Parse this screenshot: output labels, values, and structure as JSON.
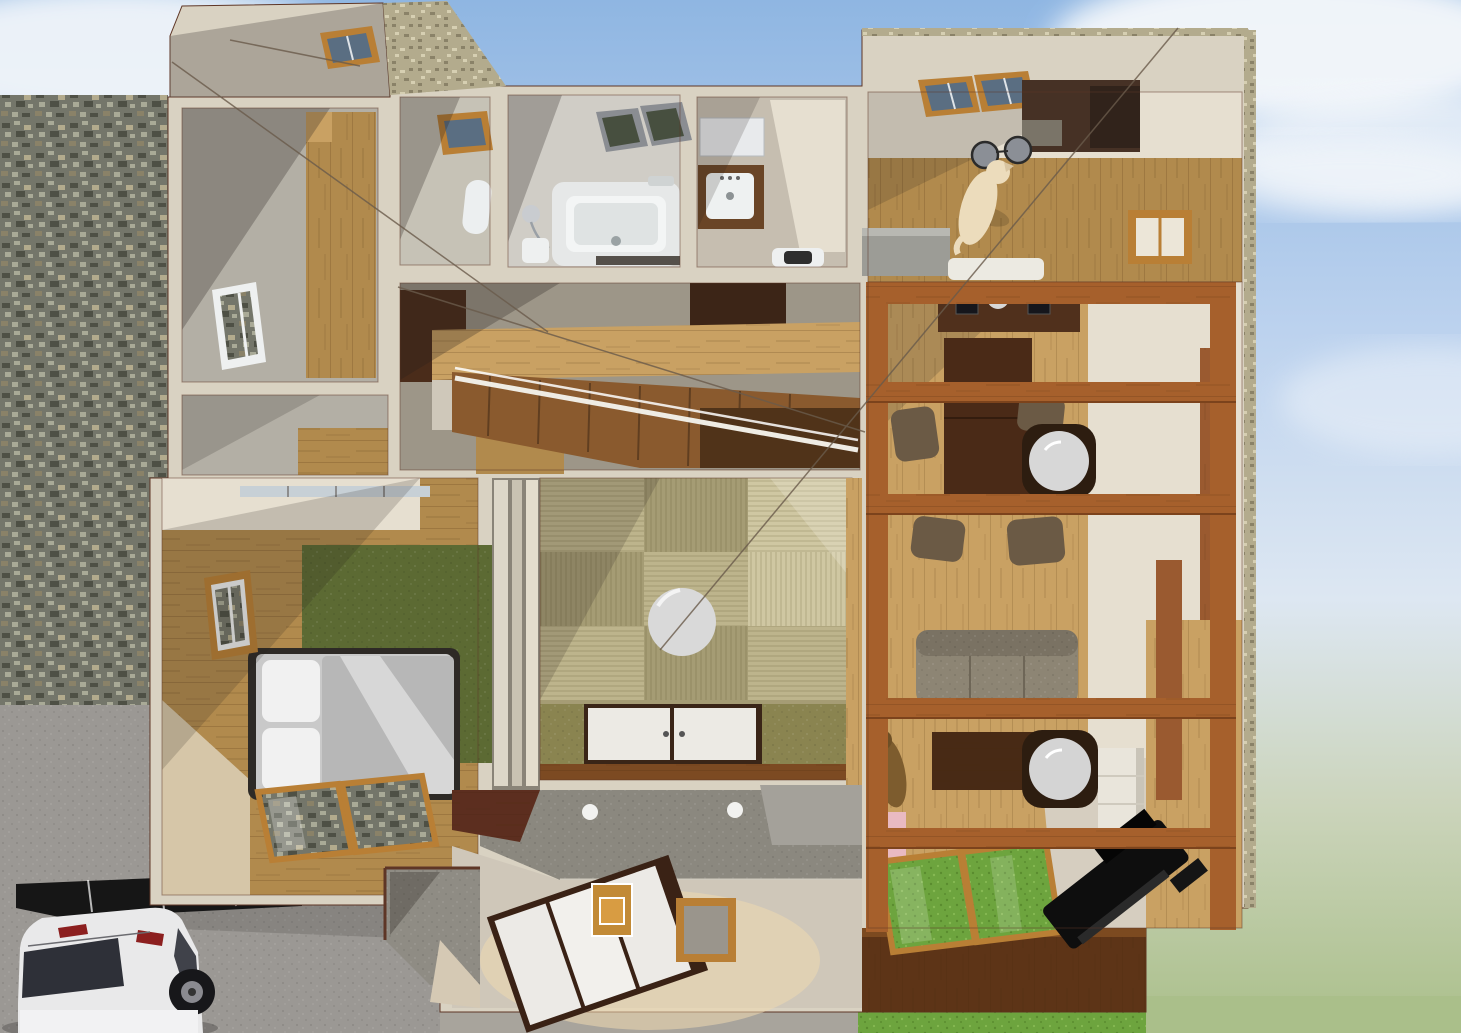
{
  "meta": {
    "description": "3D top-down cutaway architectural rendering of a furnished Japanese house with open roof, surrounded by sky, stone retaining wall, driveway with carport and white minivan, and lawn",
    "render_style": "architectural visualization, no visible UI chrome or text"
  },
  "palette": {
    "sky-top": "#8fb6e2",
    "sky-mid": "#bcd2ee",
    "sky-low": "#dde7f2",
    "sky-green": "#cbd4bb",
    "cloud": "#f5f8fb",
    "stone-base": "#74766a",
    "stone-dark": "#4e5045",
    "stone-light": "#a9aa97",
    "gravel-base": "#b3ab8d",
    "gravel-dark": "#8a8268",
    "gravel-light": "#d6cfb2",
    "wall-cream": "#d9d2c2",
    "wall-line": "#5e3626",
    "wall-lit": "#e6dfd0",
    "wall-shadow": "#a59f94",
    "wall-gray": "#b3afa5",
    "wood-light": "#c9a163",
    "wood-mid": "#b18a4d",
    "wood-dark": "#8a5a2e",
    "wood-deep": "#4a2c1a",
    "wood-red": "#5c2e1f",
    "beam": "#a6602c",
    "beam-dark": "#7c431c",
    "deck-dark": "#5d3417",
    "tatami-a": "#a59c74",
    "tatami-b": "#bdb48c",
    "tatami-hi": "#cfc7a2",
    "mat-green": "#8a8450",
    "rug-green": "#5c6a33",
    "grass": "#6da43e",
    "grass-pale": "#aabf8a",
    "floor-beige": "#d6cec0",
    "genkan-dark": "#8b887f",
    "genkan-light": "#cfc7b9",
    "white-soft": "#eceae4",
    "gray-blanket": "#b7b7b7",
    "dark-frame": "#2e2a26",
    "glass-dark": "#55636f",
    "glass-roof": "#5a6e82",
    "glass-olive": "#474f3f",
    "frame-wood": "#b97f35",
    "table-dark": "#4a2a17",
    "lantern-ring": "#2d1d10",
    "lantern-white": "#d7d7d7",
    "sofa": "#8d8574",
    "chair": "#6b5a45",
    "cab-dark": "#463125",
    "counter-gray": "#9c9c96",
    "dog-cream": "#ecdcbc",
    "dog-brown": "#7d5c2e",
    "pink": "#e9bac2",
    "piano": "#0e0e0e",
    "car-white": "#e9e9ea",
    "car-dark": "#2e3038",
    "car-red": "#8c1f1f",
    "drive-gray": "#9b9894",
    "carport": "#161616",
    "wire": "#6a5b4b",
    "panel-brown": "#9a5a30"
  },
  "scene": {
    "sky": {
      "clouds": true,
      "gradient_to_green_horizon": true
    },
    "exterior": [
      "stone-retaining-wall",
      "gravel-wall-tops",
      "driveway",
      "carport",
      "white-minivan",
      "lawn",
      "approach-porch",
      "dimension-wires"
    ],
    "rooms": [
      {
        "name": "stairwell-room",
        "furniture": [
          "wood-floor-strip",
          "window",
          "roof-skylight"
        ]
      },
      {
        "name": "toilet-room",
        "furniture": [
          "skylight",
          "toilet"
        ]
      },
      {
        "name": "bathroom",
        "furniture": [
          "bathtub",
          "shower-head",
          "bath-stool",
          "skylight-windows",
          "floor-drain"
        ]
      },
      {
        "name": "washroom",
        "furniture": [
          "mirror-cabinet",
          "vanity-sink",
          "washing-machine"
        ]
      },
      {
        "name": "kitchen-dining-room",
        "furniture": [
          "dark-kitchen-cabinets",
          "range-hood",
          "pendant-lights",
          "dog",
          "kitchen-counter",
          "white-bench",
          "wood-window"
        ]
      },
      {
        "name": "dining-area",
        "furniture": [
          "kitchen-island",
          "dining-table",
          "dining-chairs",
          "round-paper-lantern",
          "ceiling-beams"
        ]
      },
      {
        "name": "living-area",
        "furniture": [
          "sofa",
          "tv-board",
          "round-paper-lantern",
          "white-cabinet",
          "dog",
          "grand-piano",
          "pink-shelf",
          "glass-floor-panels",
          "wood-deck"
        ]
      },
      {
        "name": "tatami-room",
        "furniture": [
          "checkered-tatami-mats",
          "round-table",
          "futon-closet-panels",
          "engawa-posts",
          "green-mats"
        ]
      },
      {
        "name": "hallway-stairs",
        "furniture": [
          "staircase",
          "white-handrail",
          "dark-closets",
          "wood-floor-band"
        ]
      },
      {
        "name": "bedroom",
        "furniture": [
          "double-bed",
          "pillows",
          "gray-blanket",
          "green-rug",
          "window",
          "glass-floor-windows",
          "glazed-roof-strip"
        ]
      },
      {
        "name": "genkan-entrance",
        "furniture": [
          "sliding-door-panels",
          "shoe-box",
          "wooden-tray",
          "downlights",
          "entry-step",
          "red-roof-wedge"
        ]
      }
    ]
  }
}
